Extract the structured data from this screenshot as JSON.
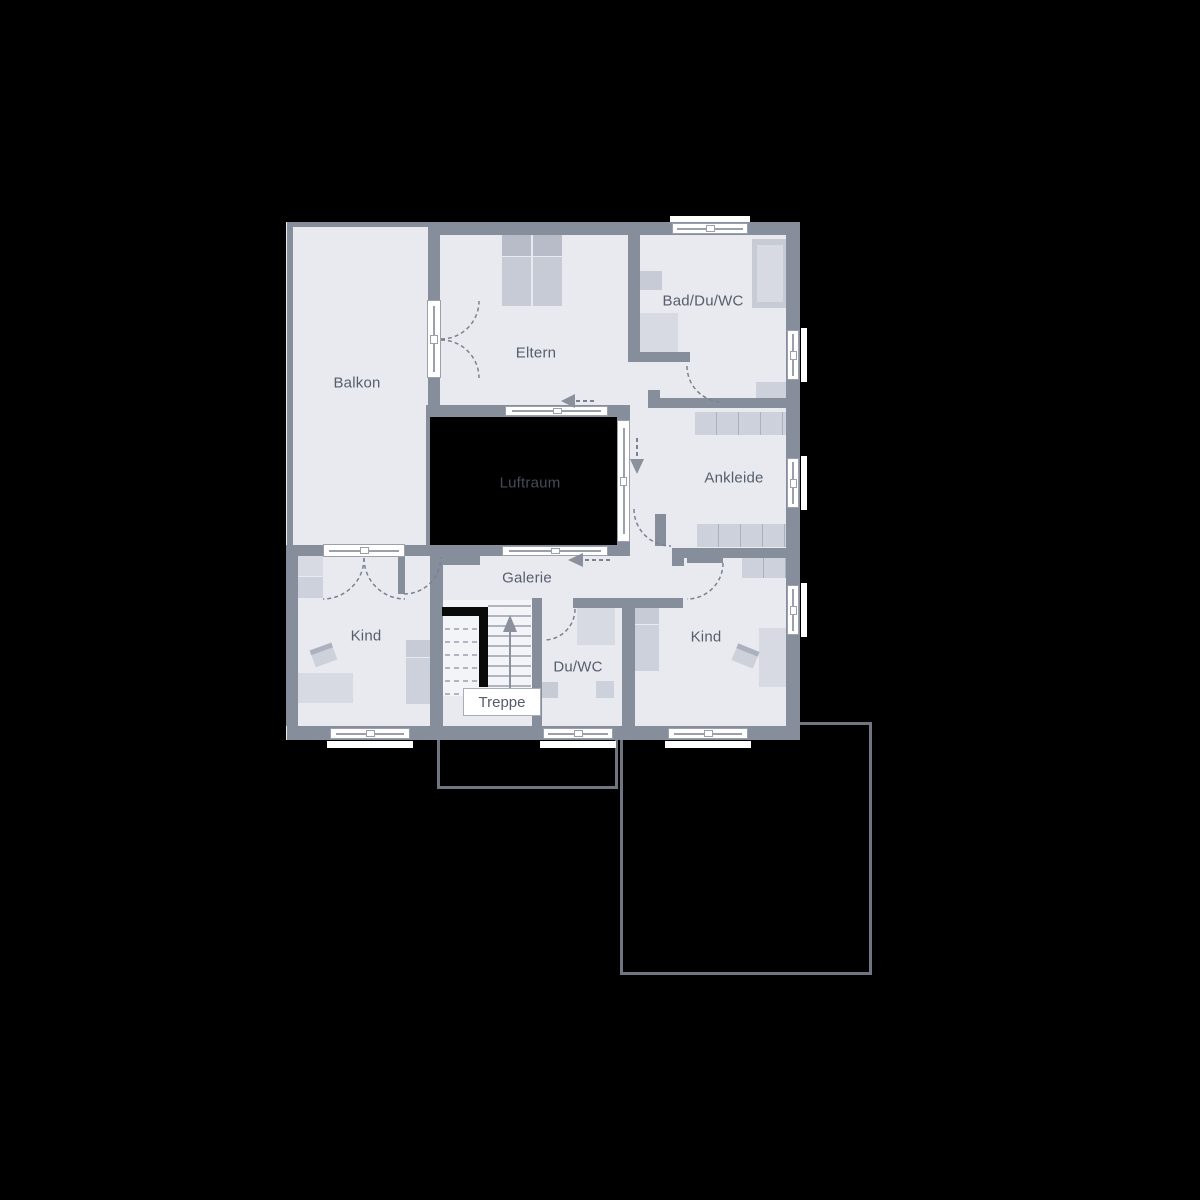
{
  "plan": {
    "type": "architectural-floor-plan",
    "rooms": [
      {
        "id": "balkon",
        "label": "Balkon"
      },
      {
        "id": "eltern",
        "label": "Eltern"
      },
      {
        "id": "bad-du-wc",
        "label": "Bad/Du/WC"
      },
      {
        "id": "luftraum",
        "label": "Luftraum"
      },
      {
        "id": "ankleide",
        "label": "Ankleide"
      },
      {
        "id": "galerie",
        "label": "Galerie"
      },
      {
        "id": "kind-west",
        "label": "Kind"
      },
      {
        "id": "du-wc",
        "label": "Du/WC"
      },
      {
        "id": "kind-east",
        "label": "Kind"
      },
      {
        "id": "treppe",
        "label": "Treppe"
      }
    ],
    "symbols": {
      "window": "double-pane-window-band",
      "door": "dashed-quarter-circle-swing-arc",
      "stairs": "treads-with-up-arrow",
      "circulation_arrows": [
        "left",
        "left",
        "down",
        "up"
      ]
    },
    "colors": {
      "background": "#000000",
      "wall": "#878e9b",
      "room_fill": "#e8eaf0",
      "furniture_light": "#d7dae3",
      "furniture_medium": "#c6cbd6",
      "void_fill": "#000000",
      "label_text": "#565d6b",
      "void_label_text": "#454b56",
      "window_white": "#ffffff",
      "lower_floor_outline": "#6f7682"
    }
  }
}
